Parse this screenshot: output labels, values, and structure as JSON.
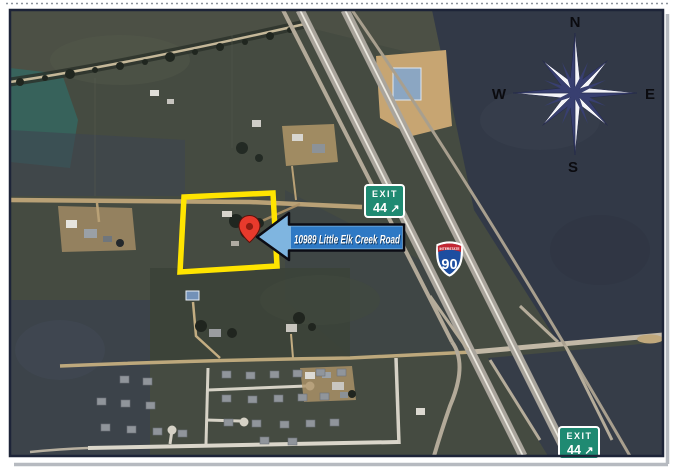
{
  "map": {
    "title": "Aerial location map",
    "compass": {
      "north": "N",
      "east": "E",
      "south": "S",
      "west": "W"
    },
    "address_banner": {
      "text": "10989 Little Elk Creek Road"
    },
    "exit_sign_top": {
      "exit_label": "EXIT",
      "number": "44",
      "arrow": "↗"
    },
    "exit_sign_bottom": {
      "exit_label": "EXIT",
      "number": "44",
      "arrow": "↗"
    },
    "interstate_shield": {
      "label": "INTERSTATE",
      "number": "90"
    },
    "colors": {
      "highlight_yellow": "#ffe400",
      "banner_box_blue": "#2e79c5",
      "banner_arrow_blue": "#7fb5e0",
      "sign_green": "#1f8a72",
      "shield_red": "#c22733",
      "shield_blue": "#1d4ea0",
      "pin_red": "#e83a2c",
      "compass_navy": "#383f70"
    }
  }
}
